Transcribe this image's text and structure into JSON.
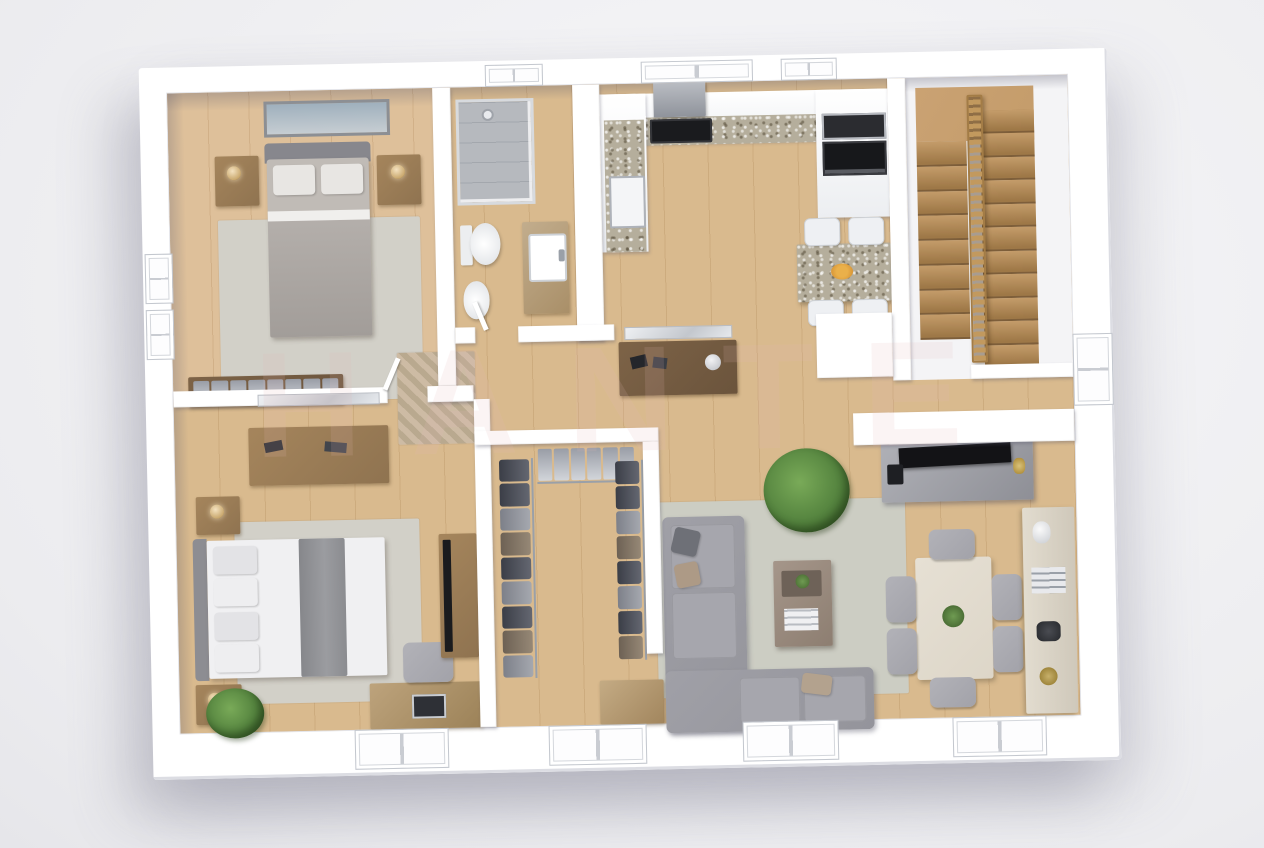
{
  "watermark": {
    "text": "HANTE"
  },
  "palette": {
    "bg1": "#f7f7f9",
    "bg2": "#ececef",
    "wall": "#ffffff",
    "wallEdge": "#dcdde3",
    "wood": "#d9ba8e",
    "woodLine": "rgba(140,95,45,0.16)",
    "tileBath": "#c7c9cc",
    "tileKitchen": "#d9d7d5",
    "rug": "#d2d0c8",
    "rugLiving": "#cccdc3",
    "sofa": "#94949b",
    "sofaSeat": "#a6a6ad",
    "throw": "#8b8c90",
    "woodFurn": "#a5855c",
    "woodFurn2": "#7d6347",
    "stair": "#c49c6a",
    "stairD": "#9e7847",
    "railing": "#c2995e",
    "granite": "#b5ae9c",
    "cream": "#ddd6c8",
    "dark": "#1a1b1e",
    "plant": "#55843f",
    "chairGray": "#a2a2a9",
    "chairWhite": "#eef0f3",
    "wmColor": "#e5b9b9"
  },
  "scene": {
    "type": "3d-floor-plan",
    "style": "top-down isometric architectural render, white cutaway walls",
    "rooms": [
      {
        "name": "bedroom-1",
        "floor": "wood",
        "furniture": [
          "double-bed",
          "two-nightstands",
          "table-lamps",
          "wall-picture",
          "area-rug",
          "built-in-wardrobe"
        ]
      },
      {
        "name": "bathroom",
        "floor": "gray-tile",
        "furniture": [
          "corner-shower",
          "toilet",
          "bidet",
          "vanity-sink"
        ]
      },
      {
        "name": "kitchen",
        "floor": "light-tile",
        "furniture": [
          "l-shaped-counter",
          "cooktop",
          "range-hood",
          "oven",
          "microwave",
          "sink",
          "breakfast-table",
          "four-white-chairs",
          "fruit-bowl"
        ]
      },
      {
        "name": "staircase",
        "floor": "white",
        "furniture": [
          "u-shaped-wood-stairs",
          "center-wood-railing",
          "upper-landing"
        ]
      },
      {
        "name": "hallway",
        "floor": "wood",
        "furniture": [
          "console-table",
          "wall-mirror",
          "patterned-rug",
          "potted-plant"
        ]
      },
      {
        "name": "master-bedroom",
        "floor": "wood",
        "furniture": [
          "double-bed",
          "two-nightstands",
          "dresser",
          "wall-mirror",
          "tv-cabinet",
          "tv",
          "desk",
          "office-chair",
          "laptop",
          "area-rug",
          "potted-plant"
        ]
      },
      {
        "name": "walk-in-closet",
        "floor": "wood",
        "furniture": [
          "hanging-clothes-rails",
          "low-dresser"
        ]
      },
      {
        "name": "living-room",
        "floor": "wood",
        "furniture": [
          "l-shaped-sectional-sofa",
          "coffee-table",
          "area-rug",
          "tv-console",
          "flat-tv",
          "media-half-wall"
        ]
      },
      {
        "name": "dining-area",
        "floor": "wood",
        "furniture": [
          "dining-table",
          "six-gray-chairs",
          "centerpiece-plant",
          "sideboard-shelf"
        ]
      }
    ],
    "stairs": {
      "flights": 2,
      "left_steps": 8,
      "right_steps": 11
    },
    "closet": {
      "left_items": 9,
      "top_items": 6,
      "right_items": 8
    },
    "wardrobe_niche_items": 8,
    "windows": {
      "top": 3,
      "left": 2,
      "bottom": 4,
      "right_doors": 1
    }
  }
}
